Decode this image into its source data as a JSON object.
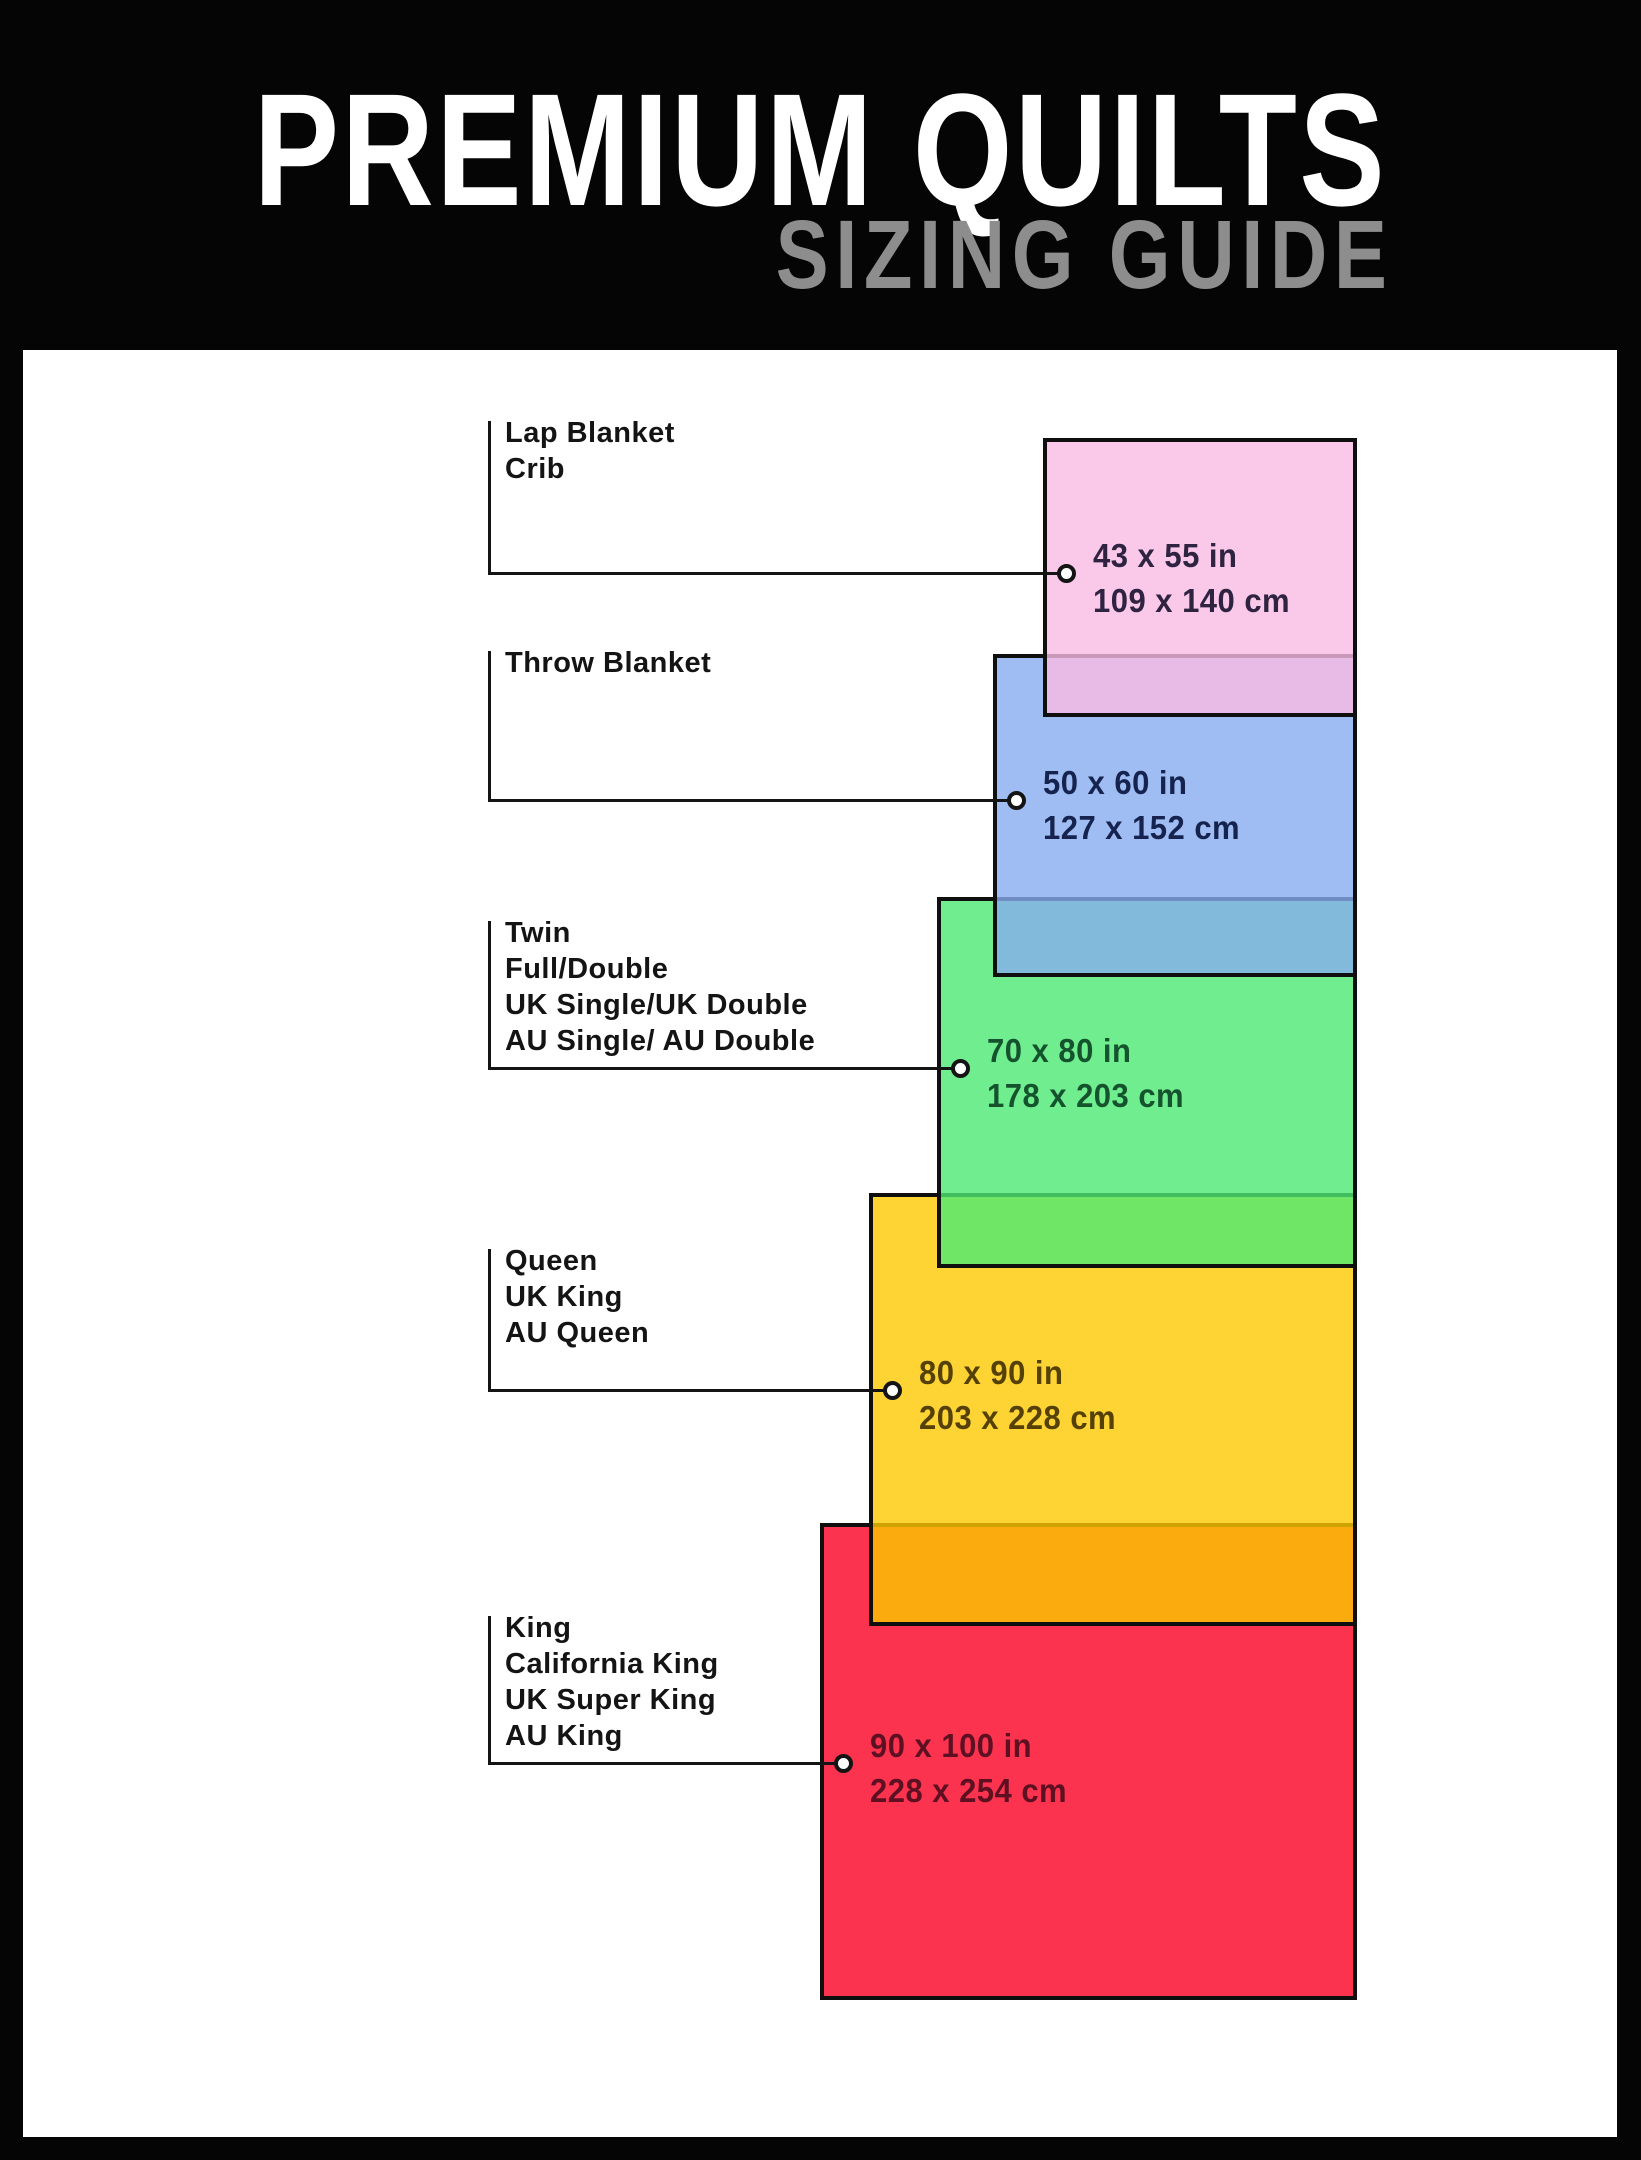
{
  "header": {
    "title": "PREMIUM QUILTS",
    "subtitle": "SIZING GUIDE"
  },
  "colors": {
    "frame": "#050505",
    "paper": "#ffffff",
    "title_text": "#ffffff",
    "subtitle_text": "#8d8d8d",
    "label_text": "#141414",
    "outline": "#0f0f0f"
  },
  "sizes": [
    {
      "id": "lap-blanket-crib",
      "label_lines": [
        "Lap Blanket",
        "Crib"
      ],
      "inches": "43 x 55 in",
      "cm": "109 x 140 cm",
      "fill": "#FAC8E8",
      "dim_text_color": "#2E2340"
    },
    {
      "id": "throw-blanket",
      "label_lines": [
        "Throw Blanket"
      ],
      "inches": "50 x 60 in",
      "cm": "127 x 152 cm",
      "fill": "#9FBDF2",
      "dim_text_color": "#15234E"
    },
    {
      "id": "twin-full-double",
      "label_lines": [
        "Twin",
        "Full/Double",
        "UK Single/UK Double",
        "AU Single/ AU Double"
      ],
      "inches": "70 x 80 in",
      "cm": "178 x 203 cm",
      "fill": "#70EE8F",
      "dim_text_color": "#14532D"
    },
    {
      "id": "queen-uk-king-au-queen",
      "label_lines": [
        "Queen",
        "UK King",
        "AU Queen"
      ],
      "inches": "80 x 90 in",
      "cm": "203 x 228 cm",
      "fill": "#FDD404",
      "dim_text_color": "#554106"
    },
    {
      "id": "king-cal-king",
      "label_lines": [
        "King",
        "California King",
        "UK Super King",
        "AU King"
      ],
      "inches": "90 x 100 in",
      "cm": "228 x 254 cm",
      "fill": "#FB2A4E",
      "dim_text_color": "#5D1022"
    }
  ]
}
